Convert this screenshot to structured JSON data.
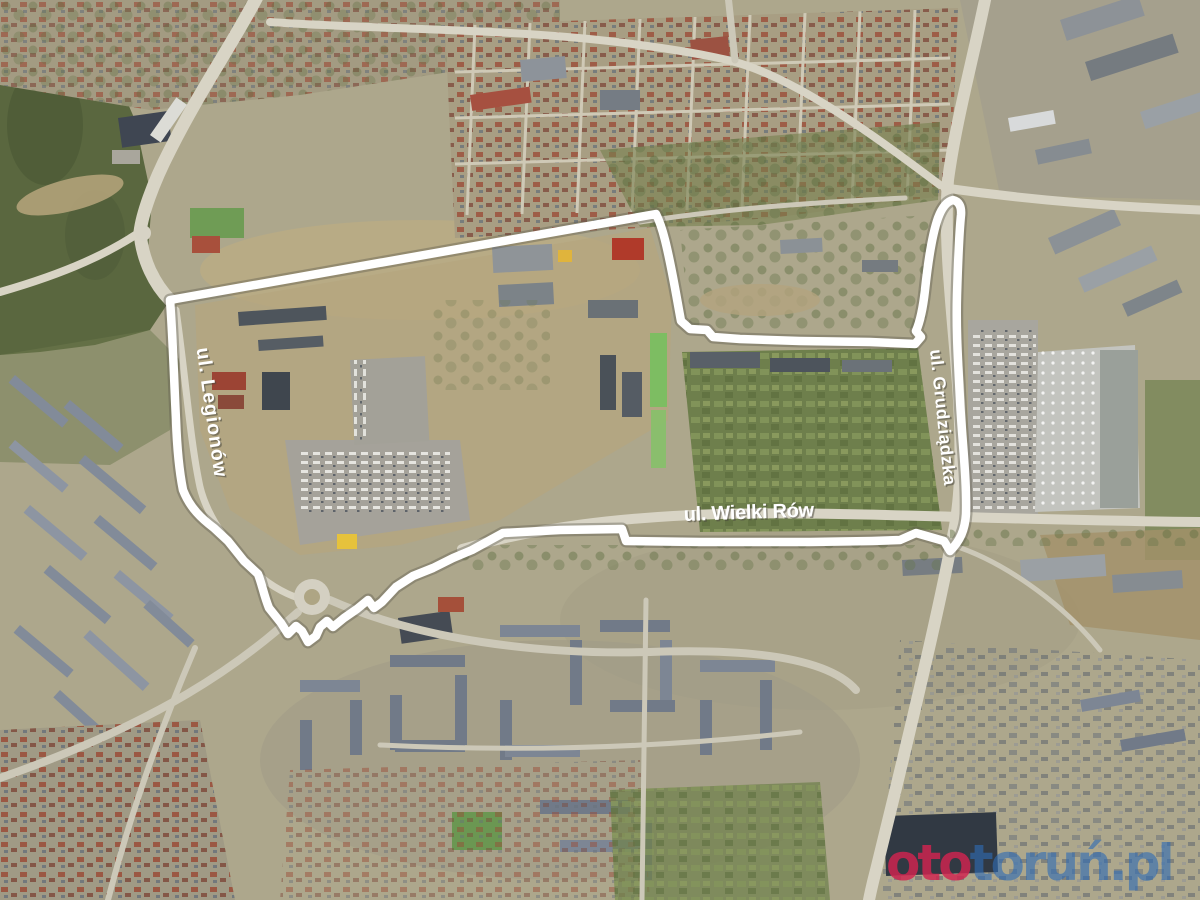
{
  "map": {
    "street_labels": {
      "left": "ul. Legionów",
      "right": "ul. Grudziądzka",
      "bottom": "ul. Wielki Rów"
    },
    "boundary": {
      "color": "#ffffff",
      "path": "M656,214 L170,300 C173,340 174,380 176,420 C177,448 179,470 183,490 C190,508 202,519 214,528 L228,541 L244,561 L258,574 C262,584 264,596 269,608 L281,623 L288,634 L296,626 L302,631 L308,642 L316,636 L320,627 L327,621 L333,627 L344,618 L357,609 L368,600 L374,608 L382,602 L396,587 L413,576 L433,568 L453,558 L472,550 L492,539 L503,533 L560,530 L622,529 L626,541 L700,542 L810,542 L872,541 L900,540 L916,533 L944,541 L950,551 C960,541 965,530 966,514 C967,480 962,440 960,400 C958,360 956,330 957,295 C958,262 959,235 961,215 Q962,202 953,200 Q944,202 938,218 C932,235 928,262 925,290 C923,308 920,322 916,331 L921,337 L915,344 L870,342 L800,341 L740,339 L713,337 L707,330 L690,329 L681,321 C677,300 672,268 665,240 C662,228 659,220 656,214 Z"
    },
    "watermark": {
      "prefix": "oto",
      "suffix": "toruń.pl",
      "prefix_color": "#d2234f",
      "suffix_color": "#2e6cb5"
    }
  }
}
